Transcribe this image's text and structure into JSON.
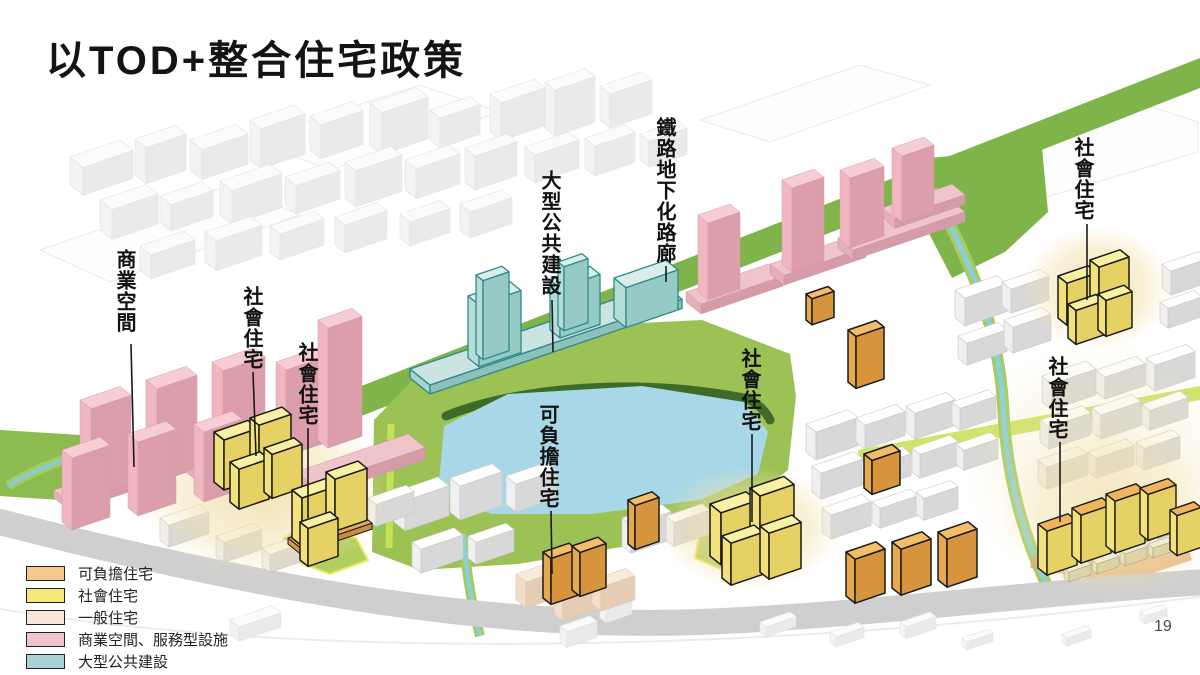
{
  "slide": {
    "title": "以TOD+整合住宅政策",
    "page_number": "19"
  },
  "legend": {
    "items": [
      {
        "label": "可負擔住宅",
        "color": "#F4C98E"
      },
      {
        "label": "社會住宅",
        "color": "#F5E878"
      },
      {
        "label": "一般住宅",
        "color": "#F9E6DA"
      },
      {
        "label": "商業空間、服務型設施",
        "color": "#EFC3C9"
      },
      {
        "label": "大型公共建設",
        "color": "#A9D2D8"
      }
    ]
  },
  "map": {
    "labels": [
      {
        "text": "商業空間"
      },
      {
        "text": "社會住宅"
      },
      {
        "text": "社會住宅"
      },
      {
        "text": "大型公共建設"
      },
      {
        "text": "鐵路地下化路廊"
      },
      {
        "text": "社會住宅"
      },
      {
        "text": "可負擔住宅"
      },
      {
        "text": "社會住宅"
      },
      {
        "text": "社會住宅"
      }
    ],
    "colors": {
      "park_green": "#9CC256",
      "corridor_green": "#7FB44A",
      "lake_blue": "#A8D8E8",
      "road_gray": "#CFCFCF"
    }
  }
}
